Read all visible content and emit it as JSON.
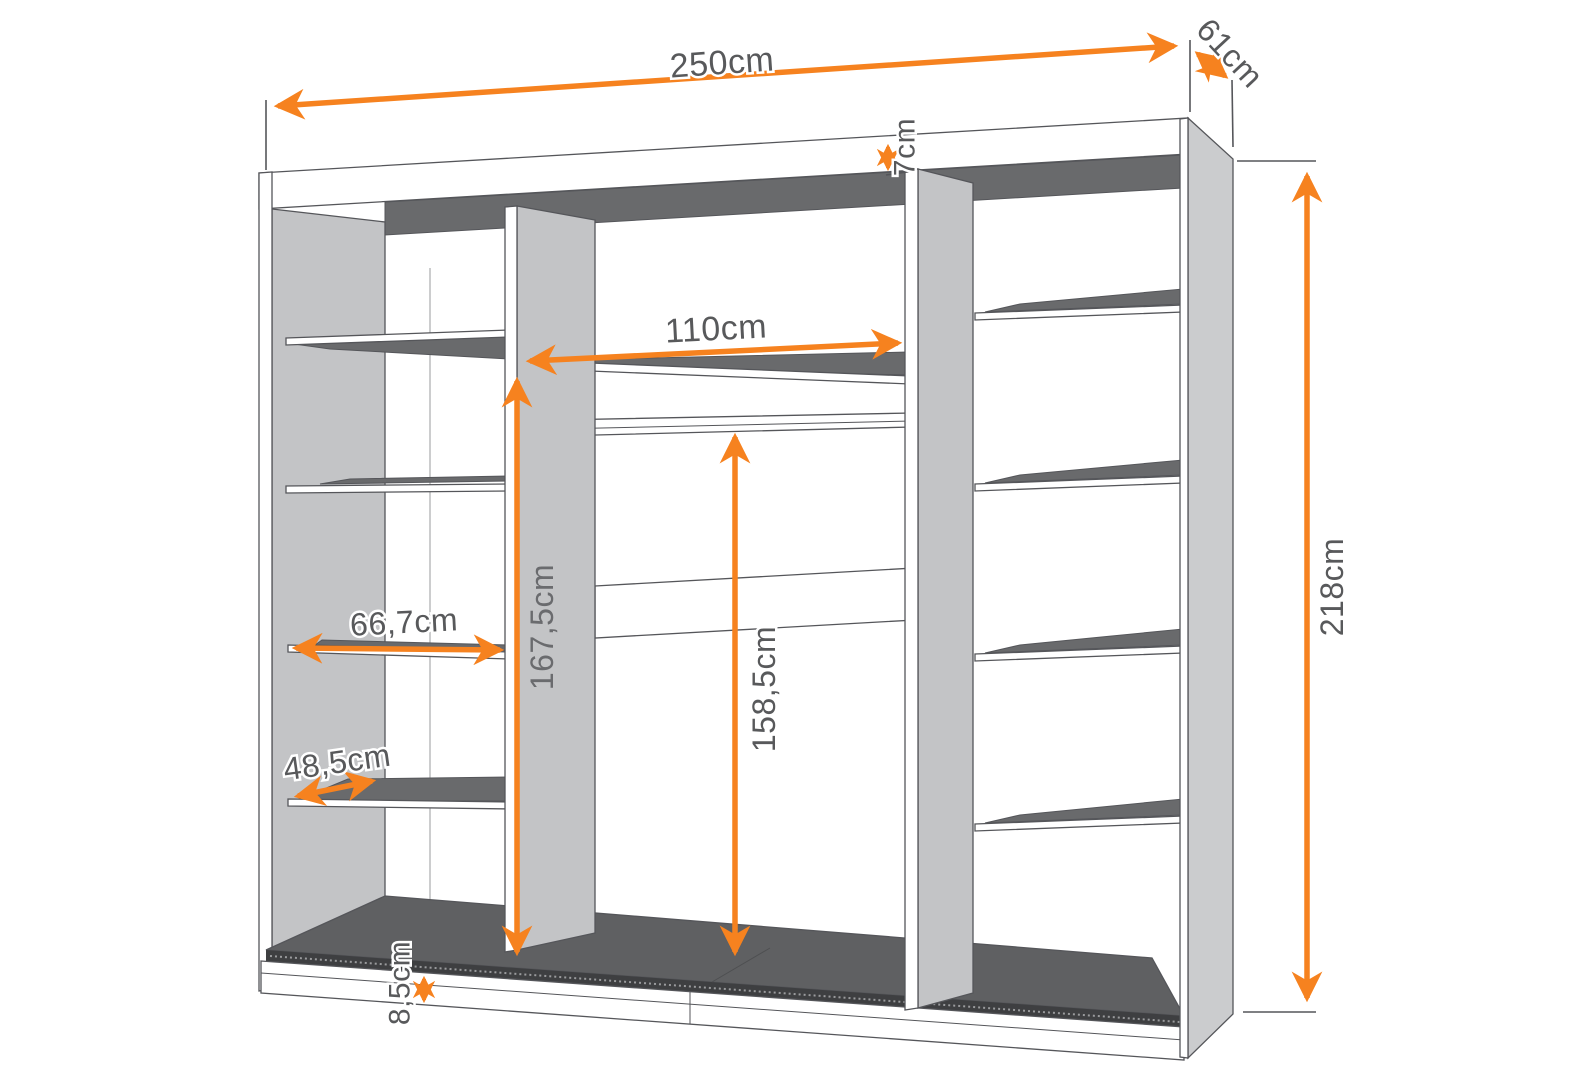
{
  "diagram": {
    "title": "wardrobe-interior-dimension-diagram",
    "unit": "cm",
    "colors": {
      "accent_orange": "#f6821f",
      "outline_grey": "#55565a",
      "panel_grey": "#c3c4c6",
      "surface_dark_grey": "#696a6c",
      "floor_dark_grey": "#5f6062",
      "label_text_grey": "#58595b",
      "background": "#ffffff"
    }
  },
  "dimensions": {
    "overall_width": "250cm",
    "overall_depth": "61cm",
    "overall_height": "218cm",
    "middle_section_width": "110cm",
    "interior_height": "167,5cm",
    "hanging_rail_height": "158,5cm",
    "upper_shelf_width": "66,7cm",
    "lower_shelf_width": "48,5cm",
    "top_panel_height": "7cm",
    "plinth_height": "8,5cm"
  }
}
